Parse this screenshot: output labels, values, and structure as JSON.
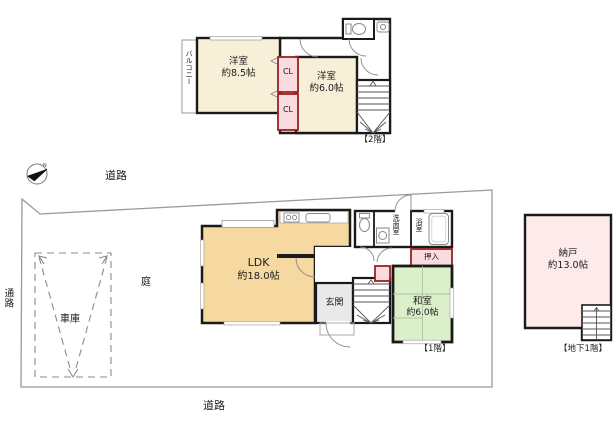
{
  "colors": {
    "wall": "#1a1a1a",
    "room_cream": "#f8efd8",
    "room_orange": "#f6d9a1",
    "room_green": "#dcefcb",
    "closet_pink": "#fadbdf",
    "closet_border": "#992222",
    "storage_pink": "#fdeaea",
    "boundary_gray": "#999999",
    "genkan_gray": "#e9e9e9"
  },
  "site": {
    "road_top": "道路",
    "road_bottom": "道路",
    "passage": "通路",
    "garden": "庭",
    "garage": "車庫",
    "compass_n": "N"
  },
  "floor2": {
    "label": "【2階】",
    "balcony": "バルコニー",
    "bedroom1_name": "洋室",
    "bedroom1_size": "約8.5帖",
    "bedroom2_name": "洋室",
    "bedroom2_size": "約6.0帖",
    "closet1": "CL",
    "closet2": "CL"
  },
  "floor1": {
    "label": "【1階】",
    "ldk_name": "LDK",
    "ldk_size": "約18.0帖",
    "entrance": "玄関",
    "washroom": "洗面室",
    "bathroom": "浴室",
    "oshiire": "押入",
    "washitsu_name": "和室",
    "washitsu_size": "約6.0帖"
  },
  "basement": {
    "label": "【地下1階】",
    "storage_name": "納戸",
    "storage_size": "約13.0帖"
  }
}
